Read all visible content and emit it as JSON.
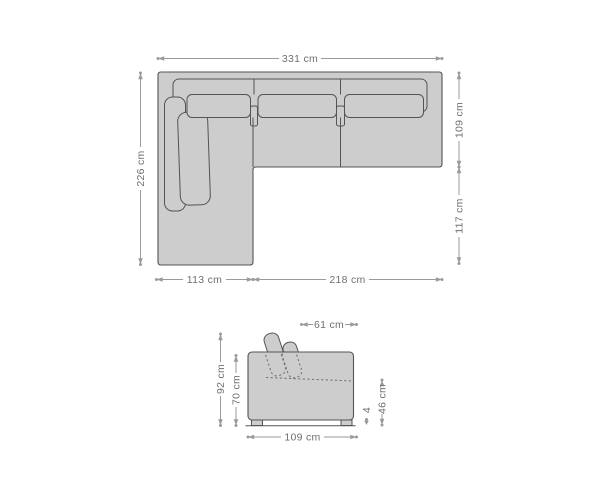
{
  "page": {
    "background": "#ffffff"
  },
  "colors": {
    "page_bg": "#ffffff",
    "sofa_fill": "#cdcdcd",
    "sofa_outline": "#545454",
    "dim_line": "#9a9a9a",
    "dim_text": "#6f6f6f",
    "hidden_line": "#6e6e6e"
  },
  "diagram": {
    "type": "furniture-dimension-drawing",
    "subject": "corner-sofa-with-chaise",
    "views": {
      "top": {
        "labels": {
          "total_width": "331 cm",
          "left_depth": "226 cm",
          "right_upper_depth": "109 cm",
          "right_lower_depth": "117 cm",
          "chaise_width": "113 cm",
          "seat_width": "218 cm"
        }
      },
      "side": {
        "labels": {
          "backrest_depth": "61 cm",
          "total_height": "92 cm",
          "backrest_height": "70 cm",
          "seat_height": "46 cm",
          "foot_height": "4",
          "total_depth": "109 cm"
        }
      }
    }
  }
}
